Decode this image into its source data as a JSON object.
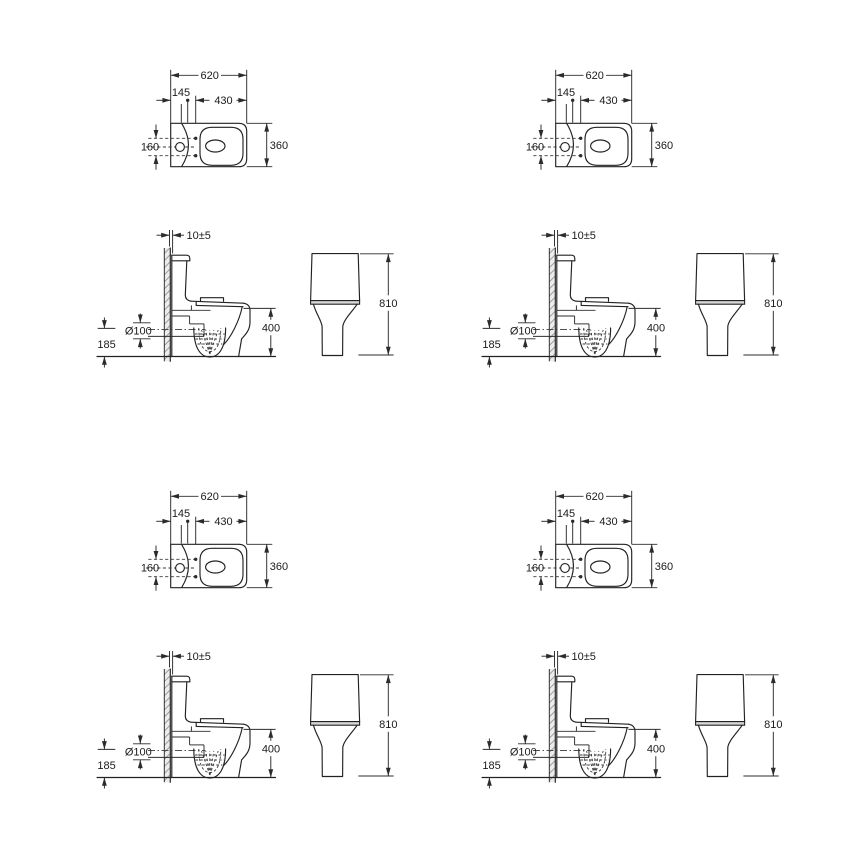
{
  "page": {
    "background": "#ffffff",
    "description": "Toilet technical dimension drawing repeated in 4 identical quadrants"
  },
  "drawing": {
    "quadrant_count": 4,
    "quadrants": [
      "top-left",
      "top-right",
      "bottom-left",
      "bottom-right"
    ],
    "colors": {
      "line": "#222222",
      "dimension": "#2b2b2b",
      "hatch": "#8f8f8f",
      "hatch_bg": "#ececec",
      "tank_band_fill": "#d6d6d6",
      "background": "#ffffff"
    },
    "top_view": {
      "overall_width": "620",
      "fixing_offset": "145",
      "bowl_length": "430",
      "hole_spacing": "160",
      "overall_depth": "360"
    },
    "side_view": {
      "wall_gap": "10±5",
      "outlet_diameter": "Ø100",
      "outlet_height": "185",
      "pan_height": "400"
    },
    "front_view": {
      "overall_height": "810"
    }
  }
}
